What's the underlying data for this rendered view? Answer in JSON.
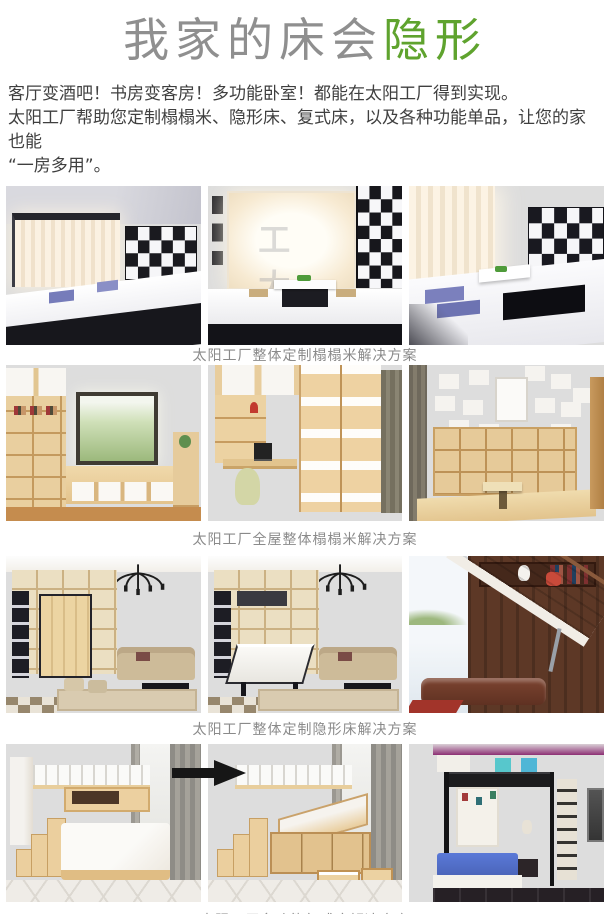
{
  "title": {
    "gray_part": "我家的床会",
    "green_part": "隐形"
  },
  "intro": {
    "line1": "客厅变酒吧！书房变客房！多功能卧室！都能在太阳工厂得到实现。",
    "line2": "太阳工厂帮助您定制榻榻米、隐形床、复式床，以及各种功能单品，让您的家也能",
    "line3": "“一房多用”。"
  },
  "sections": [
    {
      "caption": "太阳工厂整体定制榻榻米解决方案"
    },
    {
      "caption": "太阳工厂全屋整体榻榻米解决方案"
    },
    {
      "caption": "太阳工厂整体定制隐形床解决方案"
    },
    {
      "caption": "太阳工厂多功能复式床解决方案"
    }
  ],
  "watermark": "工太",
  "colors": {
    "accent_green": "#5fa32e",
    "title_gray": "#8f8f8f",
    "body_text": "#3f3f3f",
    "caption_gray": "#8a8a8a"
  }
}
